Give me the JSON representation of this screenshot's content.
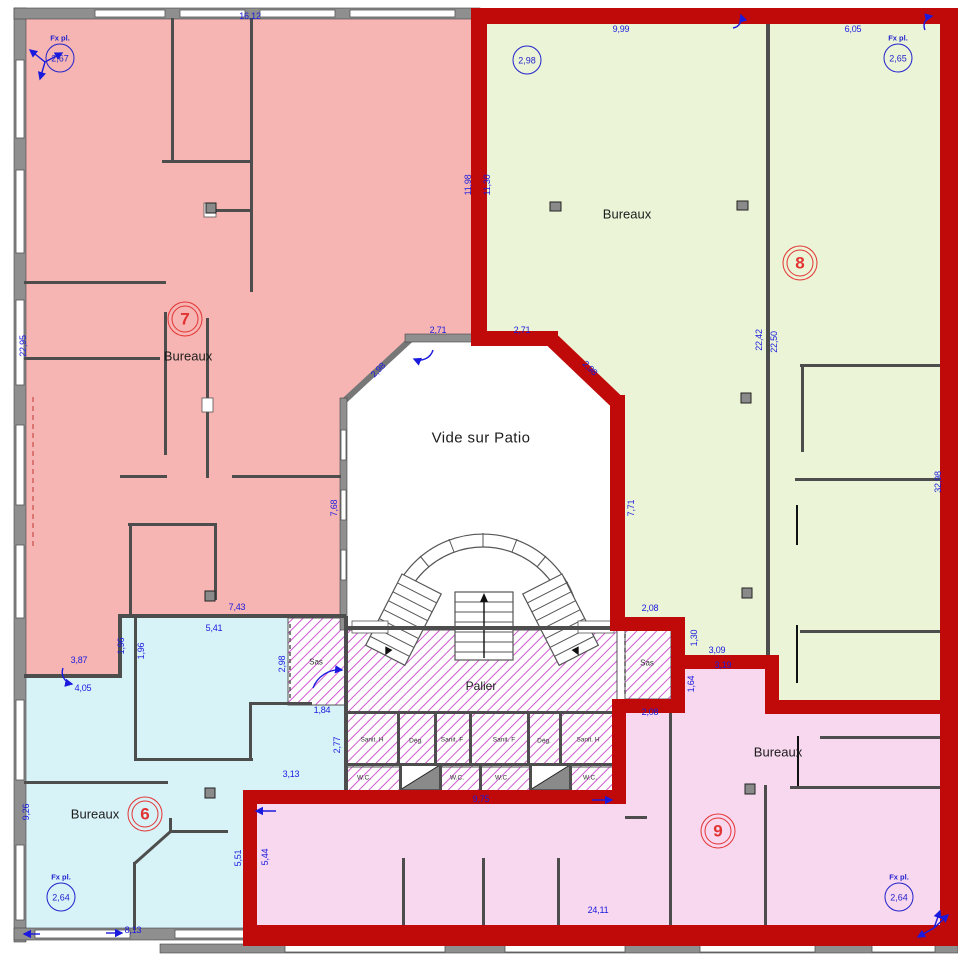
{
  "title": "Floor plan with office zones 6, 7, 8, 9",
  "colors": {
    "zone7": "#f6b5b2",
    "zone8": "#ebf4d7",
    "zone6": "#d8f3f8",
    "zone9": "#f8d8ee",
    "border_red": "#c00a0a",
    "wall_gray": "#8f8f8f",
    "wall_dark": "#4d4d4d",
    "dim_blue": "#1a1adf",
    "circle_blue": "#2222cc",
    "zone_red": "#e23333",
    "hatch_magenta": "#cf5ad0"
  },
  "zones": [
    {
      "number": "6",
      "room": "Bureaux",
      "color_key": "zone6"
    },
    {
      "number": "7",
      "room": "Bureaux",
      "color_key": "zone7"
    },
    {
      "number": "8",
      "room": "Bureaux",
      "color_key": "zone8"
    },
    {
      "number": "9",
      "room": "Bureaux",
      "color_key": "zone9"
    }
  ],
  "dimensions": [
    {
      "t": "16,12",
      "x": 250,
      "y": 16
    },
    {
      "t": "9,99",
      "x": 621,
      "y": 29
    },
    {
      "t": "6,05",
      "x": 853,
      "y": 29
    },
    {
      "t": "11,98",
      "x": 468,
      "y": 185,
      "r": -90
    },
    {
      "t": "11,30",
      "x": 487,
      "y": 185,
      "r": -90
    },
    {
      "t": "22,95",
      "x": 23,
      "y": 346,
      "r": -90
    },
    {
      "t": "22,42",
      "x": 759,
      "y": 340,
      "r": -90
    },
    {
      "t": "22,50",
      "x": 774,
      "y": 342,
      "r": -90
    },
    {
      "t": "32,98",
      "x": 938,
      "y": 482,
      "r": -90
    },
    {
      "t": "2,71",
      "x": 438,
      "y": 330
    },
    {
      "t": "2,71",
      "x": 522,
      "y": 330
    },
    {
      "t": "2,98",
      "x": 378,
      "y": 370,
      "r": -45
    },
    {
      "t": "2,98",
      "x": 590,
      "y": 368,
      "r": 45
    },
    {
      "t": "7,68",
      "x": 334,
      "y": 508,
      "r": -90
    },
    {
      "t": "7,71",
      "x": 631,
      "y": 508,
      "r": -90
    },
    {
      "t": "7,43",
      "x": 237,
      "y": 607
    },
    {
      "t": "5,41",
      "x": 214,
      "y": 628
    },
    {
      "t": "1,96",
      "x": 121,
      "y": 646,
      "r": -90
    },
    {
      "t": "1,96",
      "x": 141,
      "y": 651,
      "r": -90
    },
    {
      "t": "3,87",
      "x": 79,
      "y": 660
    },
    {
      "t": "4,05",
      "x": 83,
      "y": 688
    },
    {
      "t": "2,98",
      "x": 282,
      "y": 664,
      "r": -90
    },
    {
      "t": "1,84",
      "x": 322,
      "y": 710
    },
    {
      "t": "2,77",
      "x": 337,
      "y": 745,
      "r": -90
    },
    {
      "t": "3,13",
      "x": 291,
      "y": 774
    },
    {
      "t": "9,26",
      "x": 26,
      "y": 812,
      "r": -90
    },
    {
      "t": "5,51",
      "x": 238,
      "y": 858,
      "r": -90
    },
    {
      "t": "5,44",
      "x": 265,
      "y": 857,
      "r": -90
    },
    {
      "t": "8,13",
      "x": 133,
      "y": 930
    },
    {
      "t": "9,75",
      "x": 481,
      "y": 799
    },
    {
      "t": "24,11",
      "x": 598,
      "y": 910
    },
    {
      "t": "2,08",
      "x": 650,
      "y": 608
    },
    {
      "t": "1,30",
      "x": 694,
      "y": 638,
      "r": -90
    },
    {
      "t": "3,09",
      "x": 717,
      "y": 650
    },
    {
      "t": "3,19",
      "x": 723,
      "y": 665
    },
    {
      "t": "1,64",
      "x": 691,
      "y": 684,
      "r": -90
    },
    {
      "t": "2,08",
      "x": 650,
      "y": 712
    }
  ],
  "room_labels": [
    {
      "t": "Bureaux",
      "x": 188,
      "y": 356
    },
    {
      "t": "Bureaux",
      "x": 627,
      "y": 214
    },
    {
      "t": "Bureaux",
      "x": 95,
      "y": 814
    },
    {
      "t": "Bureaux",
      "x": 778,
      "y": 752
    },
    {
      "t": "Vide sur Patio",
      "x": 481,
      "y": 438,
      "cls": "lg"
    },
    {
      "t": "Palier",
      "x": 481,
      "y": 686,
      "cls": "md"
    },
    {
      "t": "Sas",
      "x": 316,
      "y": 662,
      "cls": "sm"
    },
    {
      "t": "Sas",
      "x": 647,
      "y": 663,
      "cls": "sm"
    },
    {
      "t": "Sanit. H",
      "x": 372,
      "y": 740,
      "cls": "xs"
    },
    {
      "t": "Dég.",
      "x": 416,
      "y": 741,
      "cls": "xs"
    },
    {
      "t": "Sanit. F",
      "x": 452,
      "y": 740,
      "cls": "xs"
    },
    {
      "t": "Sanit. F",
      "x": 504,
      "y": 740,
      "cls": "xs"
    },
    {
      "t": "Dég.",
      "x": 544,
      "y": 741,
      "cls": "xs"
    },
    {
      "t": "Sanit. H",
      "x": 588,
      "y": 740,
      "cls": "xs"
    },
    {
      "t": "W.C.",
      "x": 364,
      "y": 778,
      "cls": "xs"
    },
    {
      "t": "W.C.",
      "x": 457,
      "y": 778,
      "cls": "xs"
    },
    {
      "t": "W.C.",
      "x": 502,
      "y": 778,
      "cls": "xs"
    },
    {
      "t": "W.C.",
      "x": 590,
      "y": 778,
      "cls": "xs"
    }
  ],
  "height_circles": [
    {
      "cap": "Fx pl.",
      "t": "2,67",
      "x": 60,
      "y": 58
    },
    {
      "t": "2,98",
      "x": 527,
      "y": 60
    },
    {
      "cap": "Fx pl.",
      "t": "2,65",
      "x": 898,
      "y": 58
    },
    {
      "cap": "Fx pl.",
      "t": "2,64",
      "x": 61,
      "y": 897
    },
    {
      "cap": "Fx pl.",
      "t": "2,64",
      "x": 899,
      "y": 897
    }
  ],
  "zone_badges": [
    {
      "t": "7",
      "x": 185,
      "y": 319
    },
    {
      "t": "8",
      "x": 800,
      "y": 263
    },
    {
      "t": "6",
      "x": 145,
      "y": 814
    },
    {
      "t": "9",
      "x": 718,
      "y": 831
    }
  ]
}
